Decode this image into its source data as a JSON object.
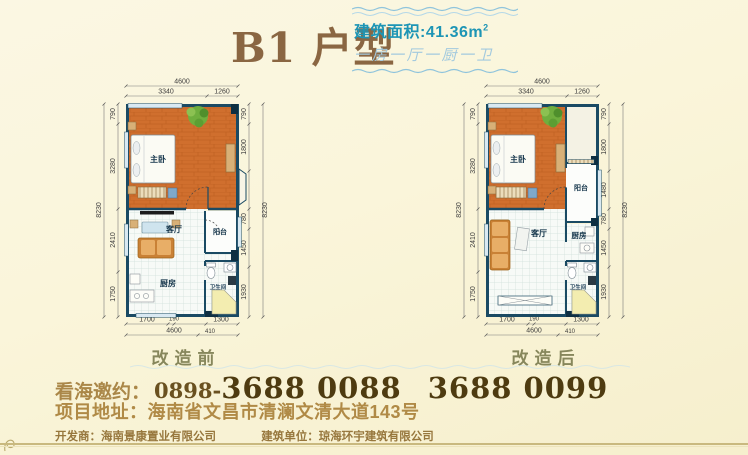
{
  "header": {
    "title": "B1 户型",
    "area_label": "建筑面积:41.36m",
    "area_sup": "2",
    "layout_desc": "一房一厅一厨一卫"
  },
  "plans": [
    {
      "caption": "改造前",
      "rooms": {
        "bedroom": "主卧",
        "living": "客厅",
        "balcony": "阳台",
        "kitchen": "厨房",
        "bath": "卫生间"
      },
      "dims": {
        "top_total": "4600",
        "top_segs": [
          "3340",
          "1260"
        ],
        "left_total": "8230",
        "left_segs": [
          "790",
          "3280",
          "2410",
          "1750"
        ],
        "right_total": "8230",
        "right_segs": [
          "790",
          "1800",
          "1480",
          "780",
          "1450",
          "1930"
        ],
        "bottom_segs": [
          "1700",
          "190",
          "1300"
        ],
        "bottom_total": "4600",
        "bottom_sub": "410"
      }
    },
    {
      "caption": "改造后",
      "rooms": {
        "bedroom": "主卧",
        "living": "客厅",
        "balcony": "阳台",
        "kitchen": "厨房",
        "bath": "卫生间"
      },
      "dims": {
        "top_total": "4600",
        "top_segs": [
          "3340",
          "1260"
        ],
        "left_total": "8230",
        "left_segs": [
          "790",
          "3280",
          "2410",
          "1750"
        ],
        "right_total": "8230",
        "right_segs": [
          "790",
          "1800",
          "1480",
          "780",
          "1450",
          "1930"
        ],
        "bottom_segs": [
          "1700",
          "190",
          "1300"
        ],
        "bottom_total": "4600",
        "bottom_sub": "410"
      }
    }
  ],
  "footer": {
    "invite_label": "看海邀约：",
    "phone_prefix": "0898-",
    "phone_number_1": "3688 0088",
    "phone_number_2": "3688 0099",
    "address": "项目地址：海南省文昌市清澜文清大道143号",
    "developer": "开发商：海南景康置业有限公司",
    "builder": "建筑单位：琼海环宇建筑有限公司"
  },
  "colors": {
    "background": "#faf5da",
    "wall_navy": "#1a4a63",
    "wood_floor": "#d2702c",
    "tile_floor": "#f7faf7",
    "accent_teal": "#1d95b5",
    "accent_lightblue": "#a3cade",
    "title_brown": "#8a6642",
    "phone_brown": "#4e3b10",
    "caption_olive": "#87875c",
    "shower_yellow": "#f3edb0"
  }
}
